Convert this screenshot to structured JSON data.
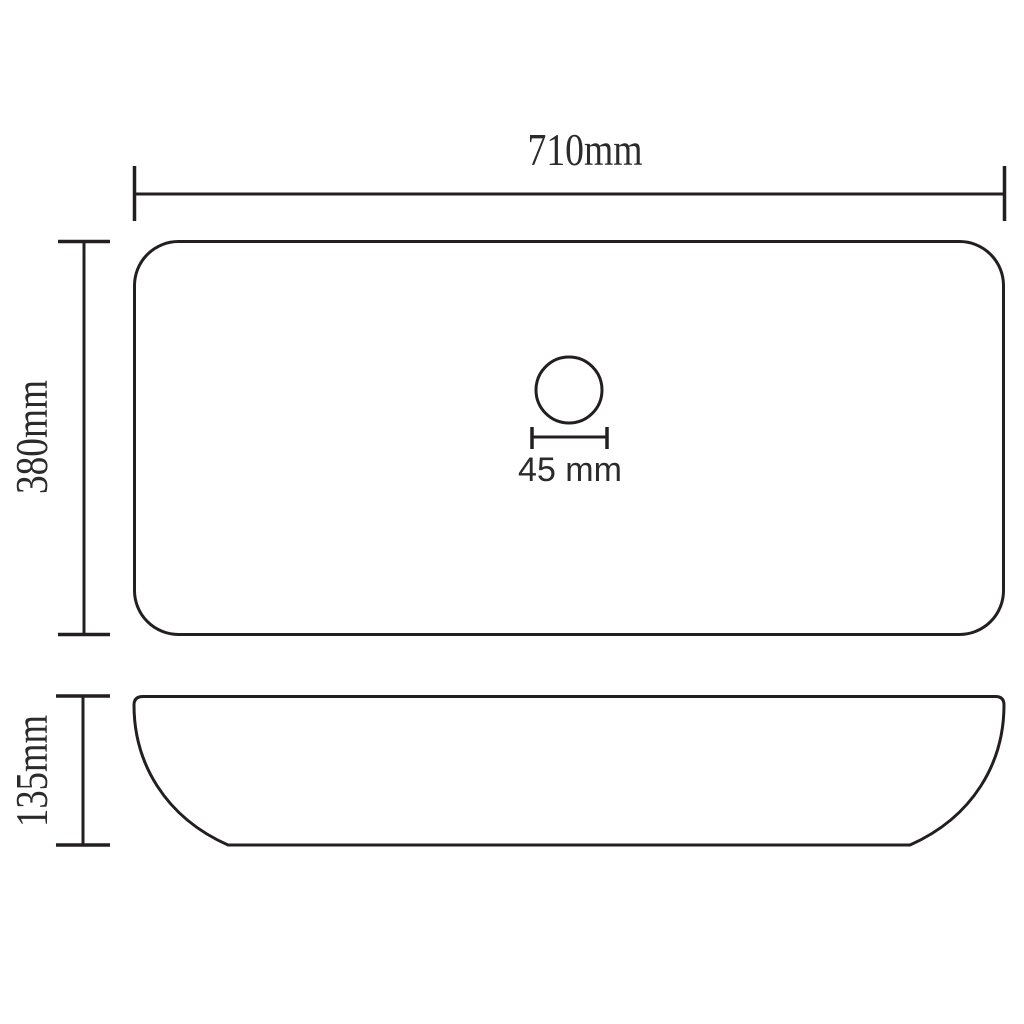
{
  "page": {
    "background_color": "#ffffff",
    "line_color": "#231f20",
    "text_color": "#2b2b2b"
  },
  "top_view": {
    "width_label": "710mm",
    "height_label": "380mm",
    "drain_diameter_label": "45 mm"
  },
  "side_view": {
    "height_label": "135mm"
  }
}
